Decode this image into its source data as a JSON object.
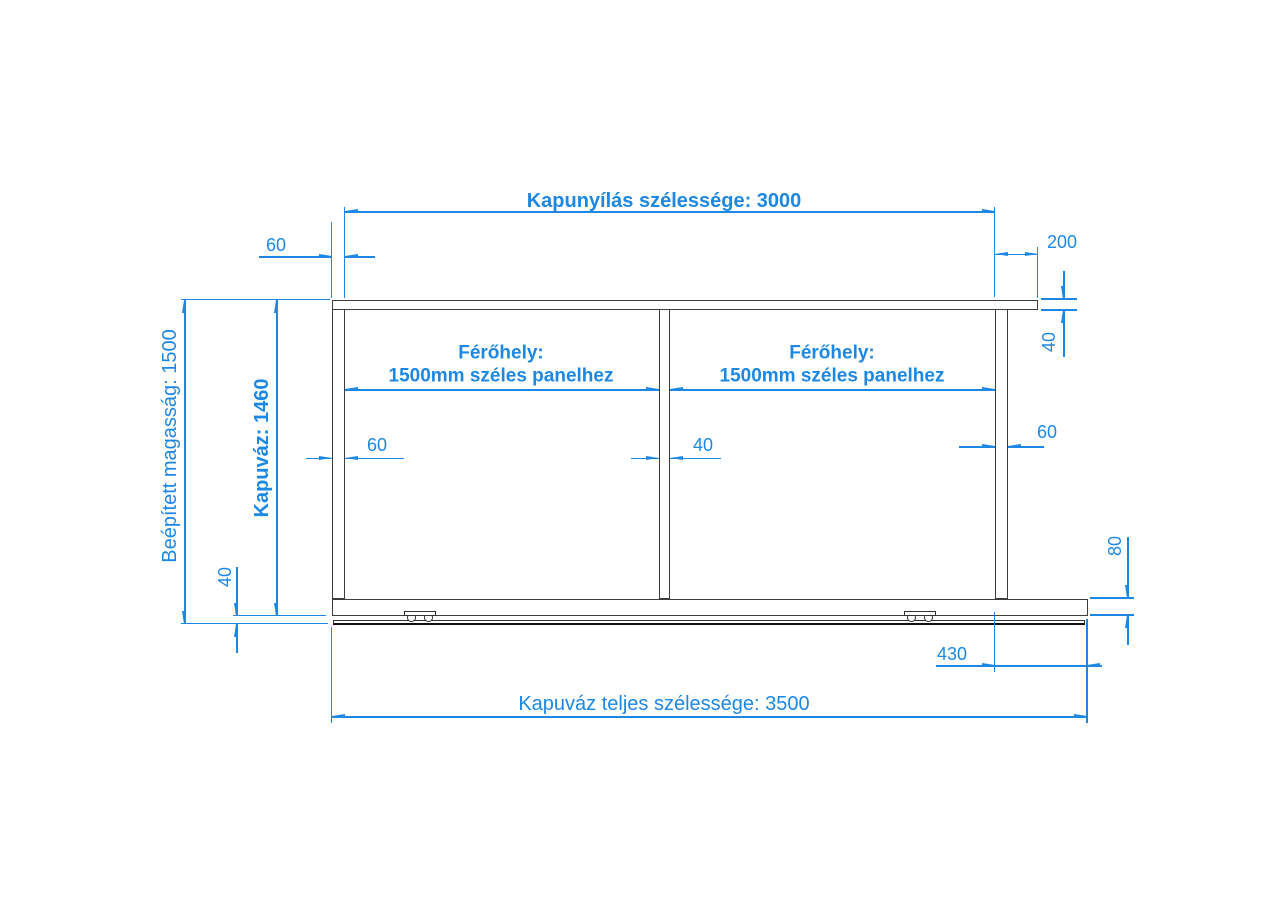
{
  "drawing": {
    "type": "technical-dimension-drawing",
    "subject": "sliding gate frame (kapuváz) front view",
    "language": "Hungarian",
    "colors": {
      "dimension_blue": "#1d87e4",
      "structure_gray": "#3d3d3d",
      "rail_black": "#111111",
      "background": "#ffffff"
    },
    "annotations": {
      "opening_width": "Kapunyílás szélessége: 3000",
      "top_left_post_width": "60",
      "top_right_overhang": "200",
      "top_bar_height": "40",
      "panel_space_title": "Férőhely:",
      "panel_space_subtitle": "1500mm széles panelhez",
      "installed_height": "Beépített magasság: 1500",
      "frame_height": "Kapuváz: 1460",
      "left_post_width": "60",
      "middle_post_width": "40",
      "right_post_width": "60",
      "ground_clearance": "40",
      "bottom_bar_height": "80",
      "bottom_right_overhang": "430",
      "total_width": "Kapuváz teljes szélessége: 3500"
    }
  }
}
